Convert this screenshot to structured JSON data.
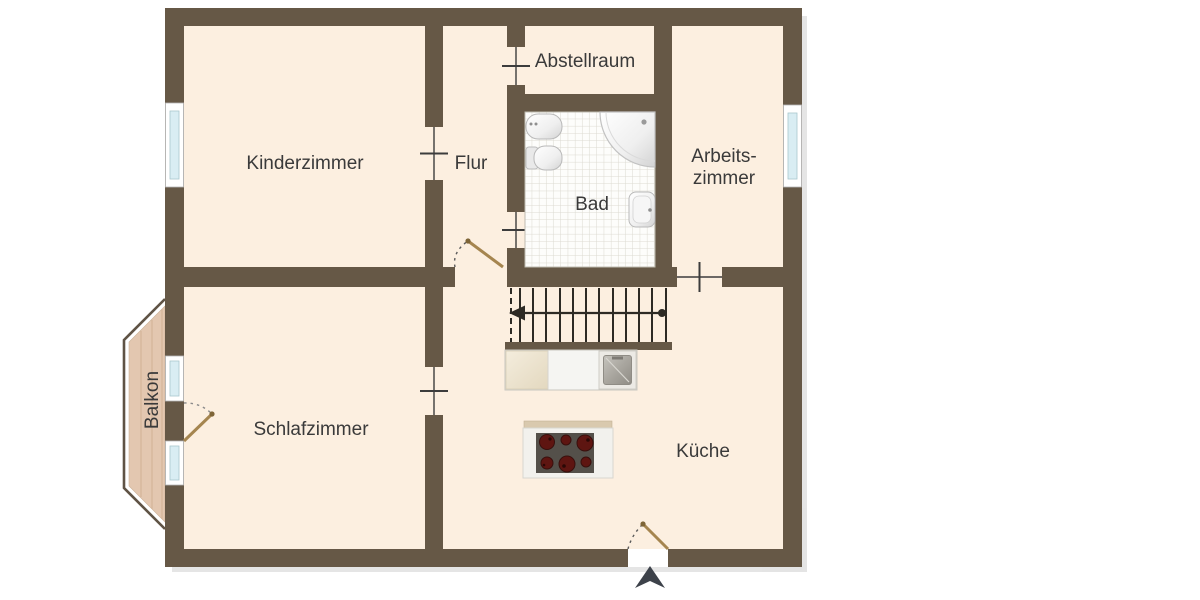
{
  "floorplan": {
    "rooms": {
      "kinderzimmer": {
        "label": "Kinderzimmer"
      },
      "flur": {
        "label": "Flur"
      },
      "abstellraum": {
        "label": "Abstellraum"
      },
      "bad": {
        "label": "Bad"
      },
      "arbeitszimmer": {
        "label_line1": "Arbeits-",
        "label_line2": "zimmer"
      },
      "schlafzimmer": {
        "label": "Schlafzimmer"
      },
      "kueche": {
        "label": "Küche"
      },
      "balkon": {
        "label": "Balkon"
      }
    },
    "fixtures": [
      "corner-shower-icon",
      "washbasin-icon",
      "toilet-icon",
      "small-washbasin-icon",
      "staircase-icon",
      "kitchen-counter-icon",
      "kitchen-sink-icon",
      "stove-six-burner-icon",
      "entrance-arrow-icon"
    ],
    "colors": {
      "wall": "#665846",
      "room_fill": "#fcefe0",
      "balcony_floor": "#e3c7b0",
      "balcony_railing": "#5f5345",
      "window_glass": "#d9edf3",
      "stair_lines": "#2d2a24",
      "burner_red": "#5e1511",
      "label_text": "#3a3a3a",
      "door_leaf": "#a5854f",
      "entrance_arrow": "#3d424a",
      "background": "#ffffff"
    }
  }
}
